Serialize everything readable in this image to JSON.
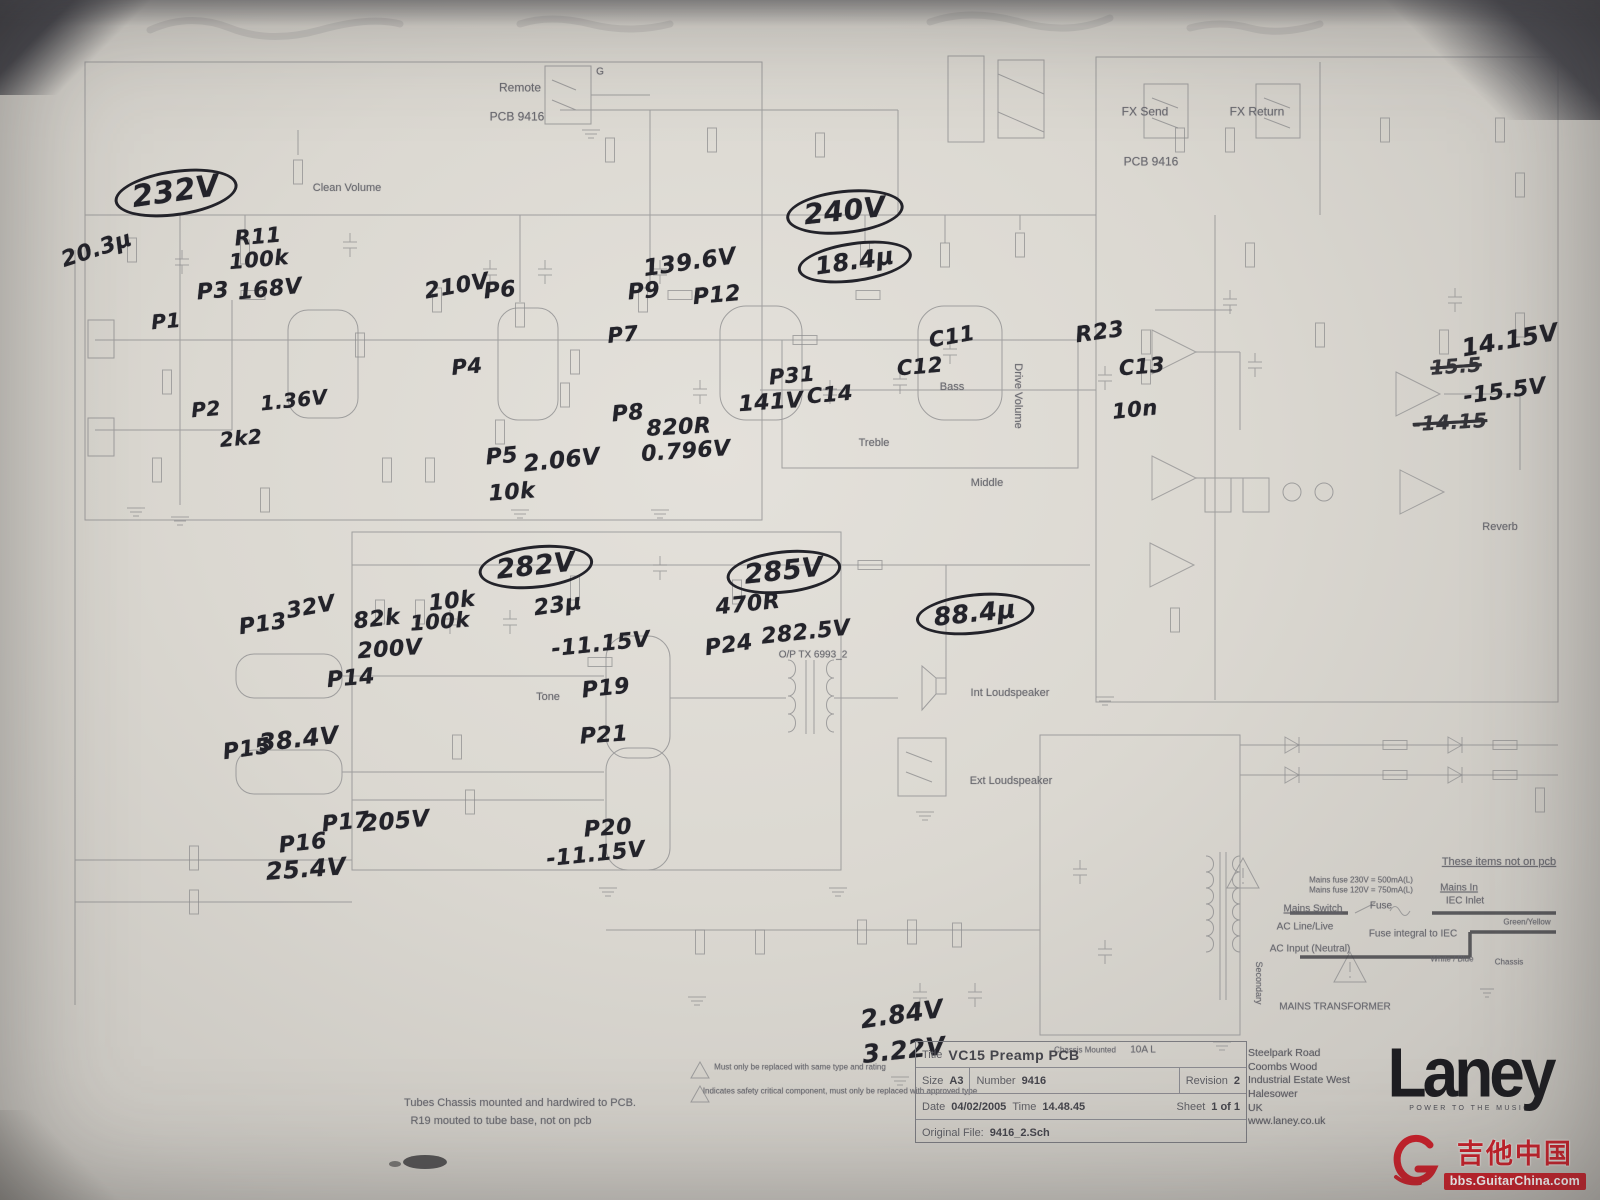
{
  "title_block": {
    "title_label": "Title",
    "title": "VC15 Preamp PCB",
    "size_label": "Size",
    "size": "A3",
    "number_label": "Number",
    "number": "9416",
    "revision_label": "Revision",
    "revision": "2",
    "date_label": "Date",
    "date": "04/02/2005",
    "time_label": "Time",
    "time": "14.48.45",
    "sheet_label": "Sheet",
    "sheet": "1 of 1",
    "file_label": "Original File:",
    "file": "9416_2.Sch"
  },
  "company": {
    "address_lines": [
      "Steelpark Road",
      "Coombs Wood",
      "Industrial Estate West",
      "Halesower",
      "UK",
      "www.laney.co.uk"
    ],
    "brand": "Laney",
    "tagline": "POWER TO THE MUSIC"
  },
  "watermark": {
    "site_name": "吉他中国",
    "site_url": "bbs.GuitarChina.com"
  },
  "printed_labels": [
    {
      "text": "Remote",
      "x": 520,
      "y": 88,
      "s": 12
    },
    {
      "text": "PCB 9416",
      "x": 517,
      "y": 117,
      "s": 12
    },
    {
      "text": "G",
      "x": 600,
      "y": 72,
      "s": 10
    },
    {
      "text": "Clean Volume",
      "x": 347,
      "y": 188,
      "s": 11
    },
    {
      "text": "FX Send",
      "x": 1145,
      "y": 112,
      "s": 12
    },
    {
      "text": "FX Return",
      "x": 1257,
      "y": 112,
      "s": 12
    },
    {
      "text": "PCB 9416",
      "x": 1151,
      "y": 162,
      "s": 12
    },
    {
      "text": "Drive Volume",
      "x": 1018,
      "y": 396,
      "s": 11,
      "vertical": true
    },
    {
      "text": "Bass",
      "x": 952,
      "y": 387,
      "s": 11
    },
    {
      "text": "Treble",
      "x": 874,
      "y": 443,
      "s": 11
    },
    {
      "text": "Middle",
      "x": 987,
      "y": 483,
      "s": 11
    },
    {
      "text": "Reverb",
      "x": 1500,
      "y": 527,
      "s": 11
    },
    {
      "text": "Tone",
      "x": 548,
      "y": 697,
      "s": 11
    },
    {
      "text": "Int Loudspeaker",
      "x": 1010,
      "y": 693,
      "s": 11
    },
    {
      "text": "Ext Loudspeaker",
      "x": 1011,
      "y": 781,
      "s": 11
    },
    {
      "text": "O/P TX 6993_2",
      "x": 813,
      "y": 655,
      "s": 10
    },
    {
      "text": "These items not on pcb",
      "x": 1499,
      "y": 862,
      "s": 11,
      "underline": true
    },
    {
      "text": "Mains fuse 230V = 500mA(L)",
      "x": 1361,
      "y": 881,
      "s": 8
    },
    {
      "text": "Mains fuse 120V = 750mA(L)",
      "x": 1361,
      "y": 891,
      "s": 8
    },
    {
      "text": "Mains In",
      "x": 1459,
      "y": 888,
      "s": 10,
      "underline": true
    },
    {
      "text": "IEC Inlet",
      "x": 1465,
      "y": 901,
      "s": 10
    },
    {
      "text": "Mains Switch",
      "x": 1313,
      "y": 909,
      "s": 10,
      "underline": true
    },
    {
      "text": "Fuse",
      "x": 1381,
      "y": 906,
      "s": 10
    },
    {
      "text": "AC Line/Live",
      "x": 1305,
      "y": 927,
      "s": 10
    },
    {
      "text": "Fuse integral to IEC",
      "x": 1413,
      "y": 934,
      "s": 10
    },
    {
      "text": "Green/Yellow",
      "x": 1527,
      "y": 923,
      "s": 8
    },
    {
      "text": "AC Input (Neutral)",
      "x": 1310,
      "y": 949,
      "s": 10
    },
    {
      "text": "White / Blue",
      "x": 1452,
      "y": 960,
      "s": 8
    },
    {
      "text": "Chassis",
      "x": 1509,
      "y": 963,
      "s": 8
    },
    {
      "text": "MAINS TRANSFORMER",
      "x": 1335,
      "y": 1007,
      "s": 10
    },
    {
      "text": "Secondary",
      "x": 1258,
      "y": 983,
      "s": 9,
      "vertical": true
    },
    {
      "text": "Chassis Mounted",
      "x": 1085,
      "y": 1051,
      "s": 8
    },
    {
      "text": "10A L",
      "x": 1143,
      "y": 1050,
      "s": 10
    },
    {
      "text": "Tubes Chassis mounted and hardwired to PCB.",
      "x": 520,
      "y": 1103,
      "s": 11
    },
    {
      "text": "R19 mouted to tube base, not on pcb",
      "x": 501,
      "y": 1121,
      "s": 11
    },
    {
      "text": "Must only be replaced with same type and rating",
      "x": 800,
      "y": 1068,
      "s": 8
    },
    {
      "text": "Indicates safety critical component, must only be replaced with approved type",
      "x": 840,
      "y": 1092,
      "s": 8
    }
  ],
  "handwritten": [
    {
      "text": "232V",
      "x": 176,
      "y": 193,
      "s": 30,
      "r": -8,
      "circled": true
    },
    {
      "text": "20.3μ",
      "x": 97,
      "y": 250,
      "s": 22,
      "r": -18
    },
    {
      "text": "R11",
      "x": 258,
      "y": 237,
      "s": 21,
      "r": -5
    },
    {
      "text": "100k",
      "x": 259,
      "y": 260,
      "s": 21,
      "r": -5
    },
    {
      "text": "P3",
      "x": 213,
      "y": 292,
      "s": 22,
      "r": -5
    },
    {
      "text": "168V",
      "x": 270,
      "y": 290,
      "s": 22,
      "r": -6
    },
    {
      "text": "P1",
      "x": 166,
      "y": 321,
      "s": 20,
      "r": -5
    },
    {
      "text": "P2",
      "x": 206,
      "y": 409,
      "s": 20,
      "r": -5
    },
    {
      "text": "2k2",
      "x": 241,
      "y": 438,
      "s": 20,
      "r": -5
    },
    {
      "text": "1.36V",
      "x": 294,
      "y": 400,
      "s": 20,
      "r": -6
    },
    {
      "text": "210V",
      "x": 457,
      "y": 287,
      "s": 22,
      "r": -10
    },
    {
      "text": "P6",
      "x": 500,
      "y": 291,
      "s": 22,
      "r": -5
    },
    {
      "text": "P4",
      "x": 467,
      "y": 367,
      "s": 21,
      "r": -5
    },
    {
      "text": "P5",
      "x": 502,
      "y": 457,
      "s": 22,
      "r": -5
    },
    {
      "text": "2.06V",
      "x": 562,
      "y": 461,
      "s": 23,
      "r": -6
    },
    {
      "text": "10k",
      "x": 512,
      "y": 493,
      "s": 22,
      "r": -4
    },
    {
      "text": "139.6V",
      "x": 690,
      "y": 263,
      "s": 23,
      "r": -8
    },
    {
      "text": "P9",
      "x": 644,
      "y": 292,
      "s": 22,
      "r": -5
    },
    {
      "text": "P12",
      "x": 717,
      "y": 296,
      "s": 22,
      "r": -5
    },
    {
      "text": "P7",
      "x": 623,
      "y": 335,
      "s": 21,
      "r": -5
    },
    {
      "text": "P8",
      "x": 628,
      "y": 414,
      "s": 22,
      "r": -5
    },
    {
      "text": "820R",
      "x": 679,
      "y": 428,
      "s": 22,
      "r": -3
    },
    {
      "text": "0.796V",
      "x": 686,
      "y": 452,
      "s": 22,
      "r": -4
    },
    {
      "text": "240V",
      "x": 845,
      "y": 212,
      "s": 28,
      "r": -6,
      "circled": true
    },
    {
      "text": "18.4μ",
      "x": 855,
      "y": 262,
      "s": 24,
      "r": -8,
      "circled": true
    },
    {
      "text": "P31",
      "x": 792,
      "y": 376,
      "s": 21,
      "r": -5
    },
    {
      "text": "141V",
      "x": 771,
      "y": 403,
      "s": 22,
      "r": -4
    },
    {
      "text": "C14",
      "x": 830,
      "y": 395,
      "s": 21,
      "r": -5
    },
    {
      "text": "C12",
      "x": 920,
      "y": 367,
      "s": 21,
      "r": -5
    },
    {
      "text": "C11",
      "x": 952,
      "y": 337,
      "s": 21,
      "r": -10
    },
    {
      "text": "R23",
      "x": 1100,
      "y": 333,
      "s": 22,
      "r": -8
    },
    {
      "text": "C13",
      "x": 1142,
      "y": 367,
      "s": 21,
      "r": -5
    },
    {
      "text": "10n",
      "x": 1135,
      "y": 410,
      "s": 21,
      "r": -6
    },
    {
      "text": "14.15V",
      "x": 1510,
      "y": 340,
      "s": 24,
      "r": -10
    },
    {
      "text": "15.5",
      "x": 1456,
      "y": 366,
      "s": 20,
      "r": -4,
      "strike": true
    },
    {
      "text": "-15.5V",
      "x": 1505,
      "y": 392,
      "s": 22,
      "r": -8
    },
    {
      "text": "-14.15",
      "x": 1450,
      "y": 422,
      "s": 20,
      "r": -3,
      "strike": true
    },
    {
      "text": "282V",
      "x": 536,
      "y": 567,
      "s": 27,
      "r": -6,
      "circled": true
    },
    {
      "text": "23μ",
      "x": 558,
      "y": 606,
      "s": 22,
      "r": -8
    },
    {
      "text": "285V",
      "x": 784,
      "y": 572,
      "s": 27,
      "r": -6,
      "circled": true
    },
    {
      "text": "470R",
      "x": 748,
      "y": 605,
      "s": 22,
      "r": -6
    },
    {
      "text": "282.5V",
      "x": 806,
      "y": 633,
      "s": 22,
      "r": -6
    },
    {
      "text": "88.4μ",
      "x": 975,
      "y": 614,
      "s": 25,
      "r": -6,
      "circled": true
    },
    {
      "text": "P13",
      "x": 263,
      "y": 625,
      "s": 22,
      "r": -8
    },
    {
      "text": "32V",
      "x": 311,
      "y": 608,
      "s": 22,
      "r": -10
    },
    {
      "text": "82k",
      "x": 377,
      "y": 620,
      "s": 22,
      "r": -6
    },
    {
      "text": "10k",
      "x": 452,
      "y": 602,
      "s": 22,
      "r": -6
    },
    {
      "text": "100k",
      "x": 440,
      "y": 622,
      "s": 21,
      "r": -4
    },
    {
      "text": "200V",
      "x": 390,
      "y": 650,
      "s": 22,
      "r": -4
    },
    {
      "text": "P14",
      "x": 351,
      "y": 679,
      "s": 22,
      "r": -5
    },
    {
      "text": "-11.15V",
      "x": 601,
      "y": 645,
      "s": 22,
      "r": -6
    },
    {
      "text": "P24",
      "x": 729,
      "y": 646,
      "s": 22,
      "r": -8
    },
    {
      "text": "P15",
      "x": 247,
      "y": 750,
      "s": 22,
      "r": -8
    },
    {
      "text": "38.4V",
      "x": 299,
      "y": 739,
      "s": 24,
      "r": -6
    },
    {
      "text": "P19",
      "x": 606,
      "y": 689,
      "s": 22,
      "r": -6
    },
    {
      "text": "P21",
      "x": 604,
      "y": 736,
      "s": 22,
      "r": -4
    },
    {
      "text": "P17",
      "x": 346,
      "y": 823,
      "s": 22,
      "r": -6
    },
    {
      "text": "205V",
      "x": 396,
      "y": 822,
      "s": 23,
      "r": -5
    },
    {
      "text": "P16",
      "x": 303,
      "y": 844,
      "s": 22,
      "r": -6
    },
    {
      "text": "25.4V",
      "x": 306,
      "y": 869,
      "s": 24,
      "r": -4
    },
    {
      "text": "P20",
      "x": 608,
      "y": 829,
      "s": 22,
      "r": -4
    },
    {
      "text": "-11.15V",
      "x": 596,
      "y": 855,
      "s": 22,
      "r": -6
    },
    {
      "text": "2.84V",
      "x": 902,
      "y": 1014,
      "s": 25,
      "r": -8
    },
    {
      "text": "3.22V",
      "x": 904,
      "y": 1050,
      "s": 25,
      "r": -6
    }
  ]
}
